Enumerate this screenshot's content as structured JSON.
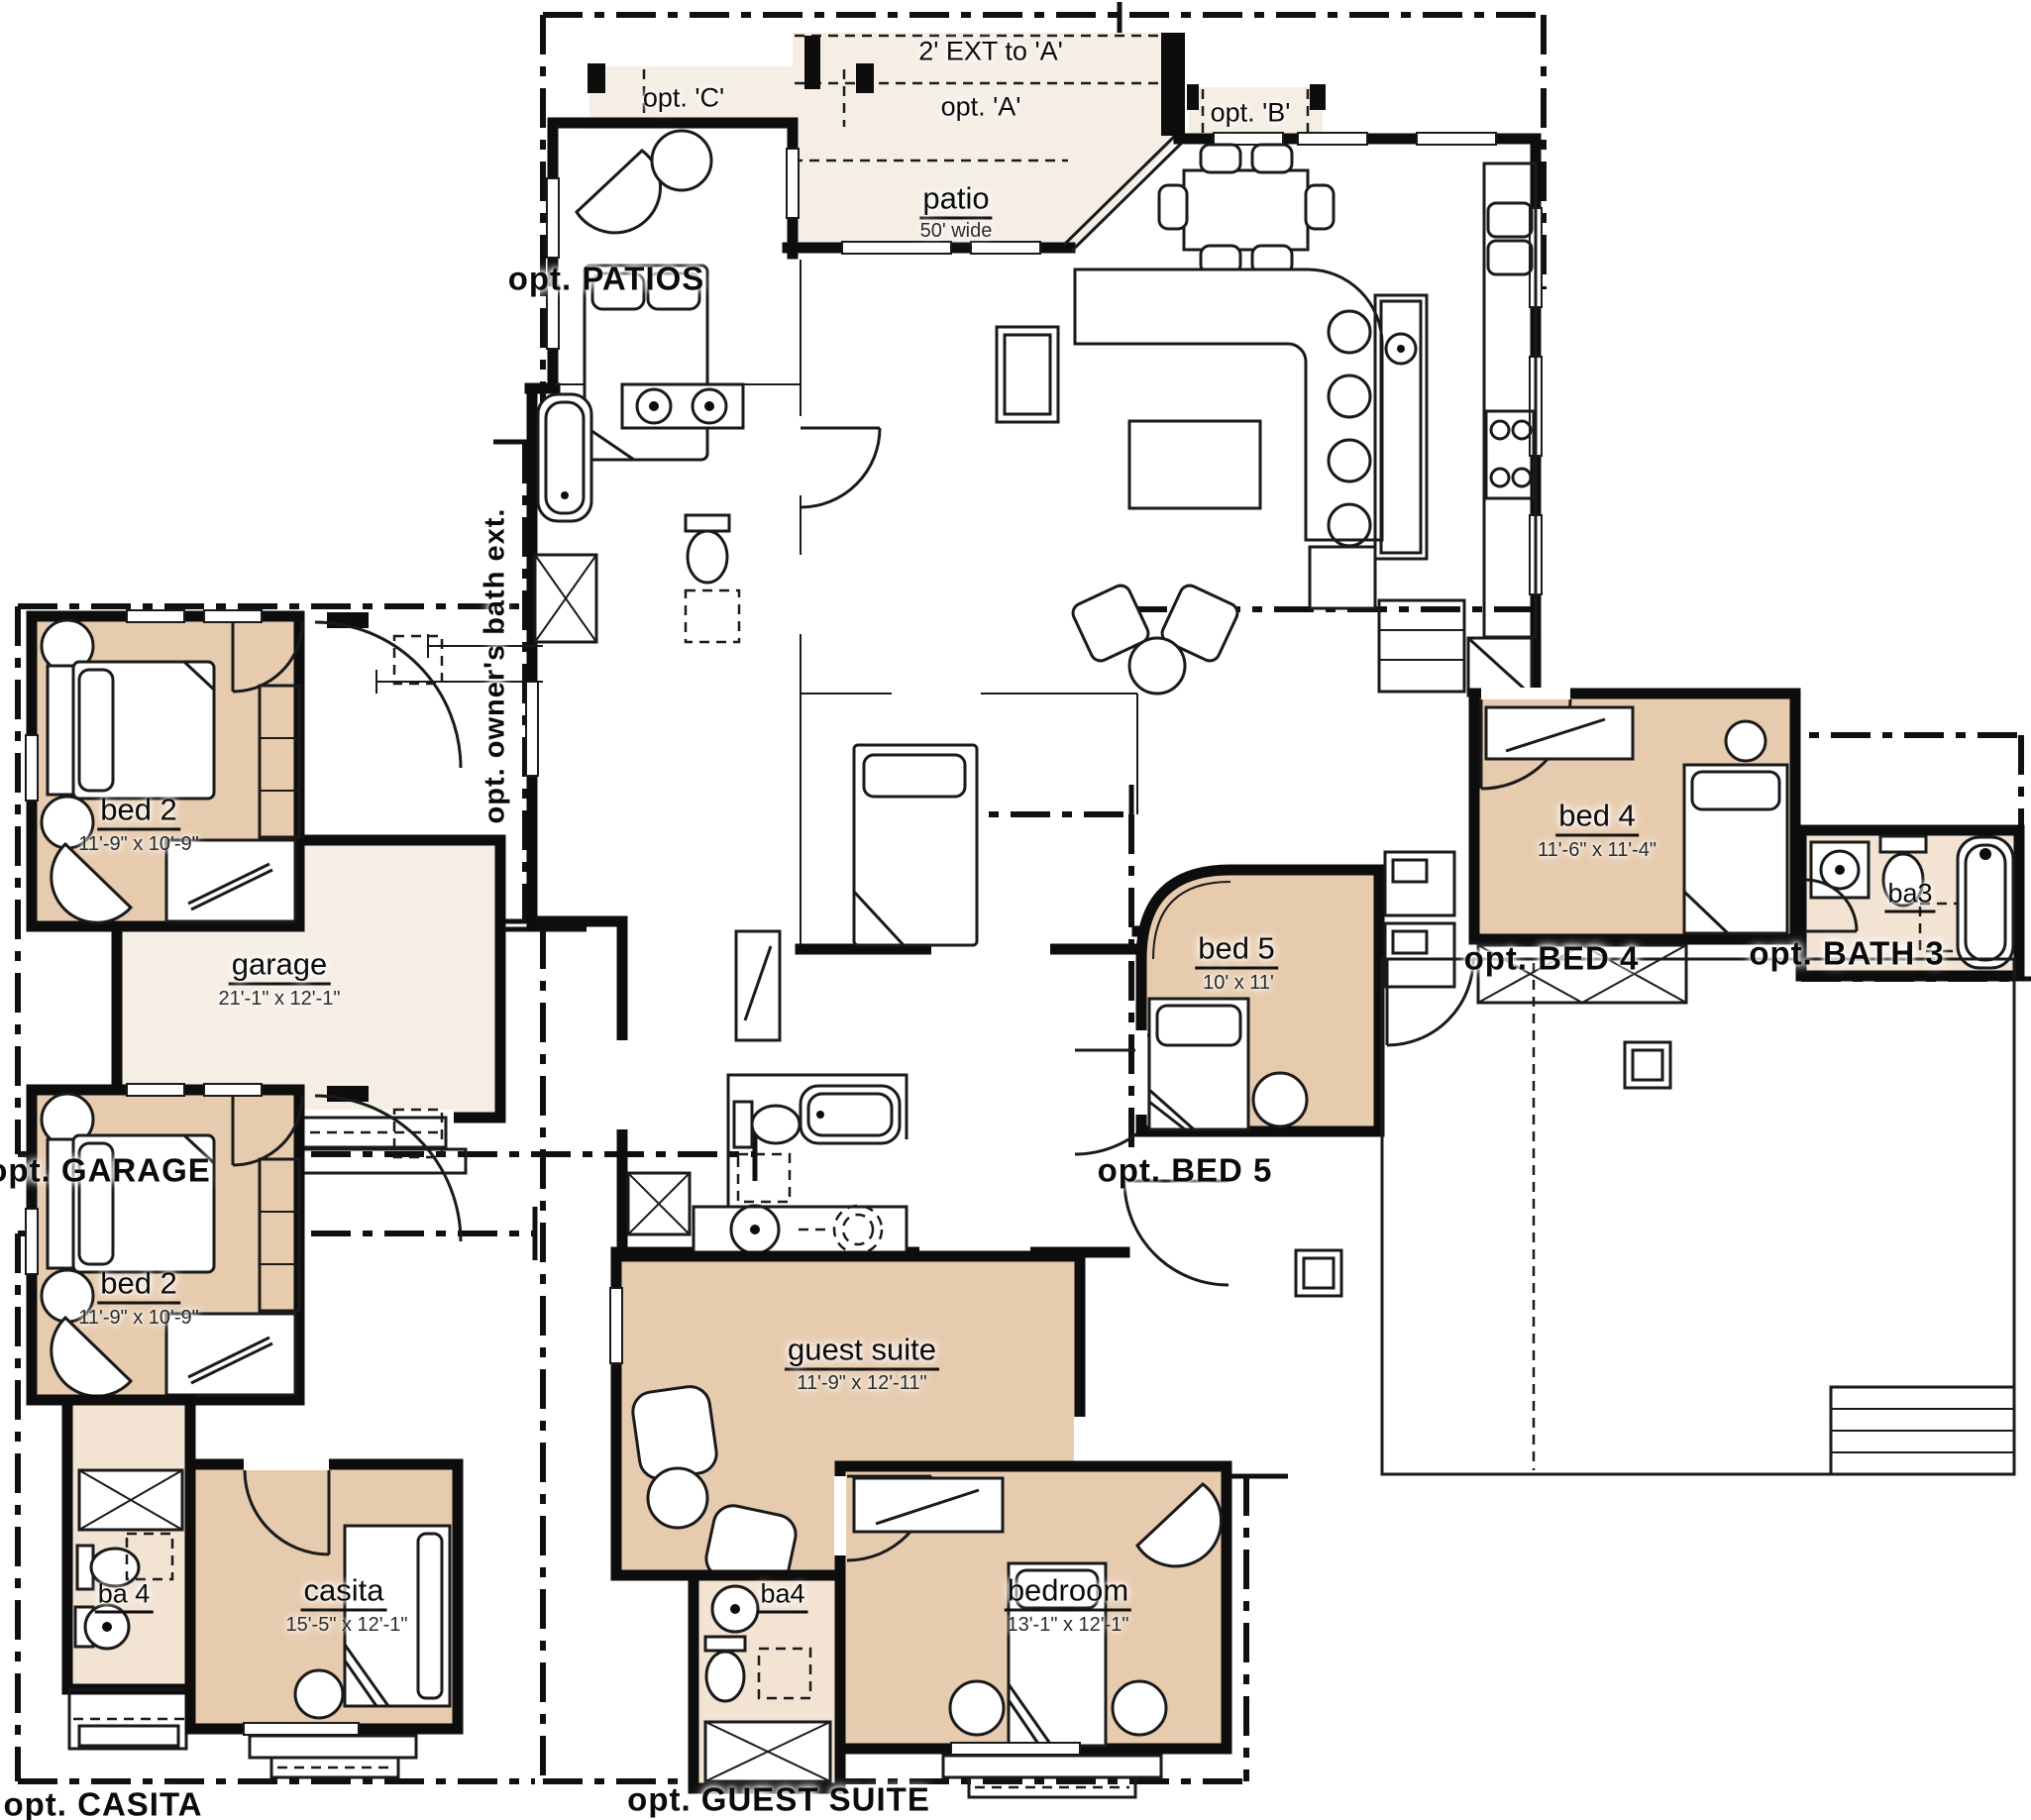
{
  "colors": {
    "room_fill": "#e7cbae",
    "bath_fill": "#f2e3d3",
    "cream_fill": "#f5eee5",
    "wall": "#0d0d0d",
    "background": "#ffffff"
  },
  "patio_options": {
    "ext_label": "2' EXT to 'A'",
    "opt_c": "opt. 'C'",
    "opt_a": "opt. 'A'",
    "opt_b": "opt. 'B'",
    "patios_label": "opt. PATIOS",
    "patio": {
      "name": "patio",
      "dim": "50' wide"
    }
  },
  "owners_bath": {
    "label": "opt. owner's bath ext."
  },
  "garage_option": {
    "label": "opt. GARAGE",
    "bed2": {
      "name": "bed 2",
      "dim": "11'-9\" x 10'-9\""
    },
    "garage": {
      "name": "garage",
      "dim": "21'-1\" x 12'-1\""
    }
  },
  "casita_option": {
    "label": "opt. CASITA",
    "bed2": {
      "name": "bed 2",
      "dim": "11'-9\" x 10'-9\""
    },
    "ba4": {
      "name": "ba 4"
    },
    "casita": {
      "name": "casita",
      "dim": "15'-5\" x 12'-1\""
    }
  },
  "guest_suite_option": {
    "label": "opt. GUEST SUITE",
    "guest_suite": {
      "name": "guest suite",
      "dim": "11'-9\" x 12'-11\""
    },
    "ba4": {
      "name": "ba4"
    },
    "bedroom": {
      "name": "bedroom",
      "dim": "13'-1\" x 12'-1\""
    }
  },
  "bed5_option": {
    "label": "opt. BED 5",
    "bed5": {
      "name": "bed 5",
      "dim": "10' x 11'"
    }
  },
  "bed4_option": {
    "label": "opt. BED 4",
    "bed4": {
      "name": "bed 4",
      "dim": "11'-6\" x 11'-4\""
    }
  },
  "bath3_option": {
    "label": "opt. BATH 3",
    "ba3": {
      "name": "ba3"
    }
  }
}
